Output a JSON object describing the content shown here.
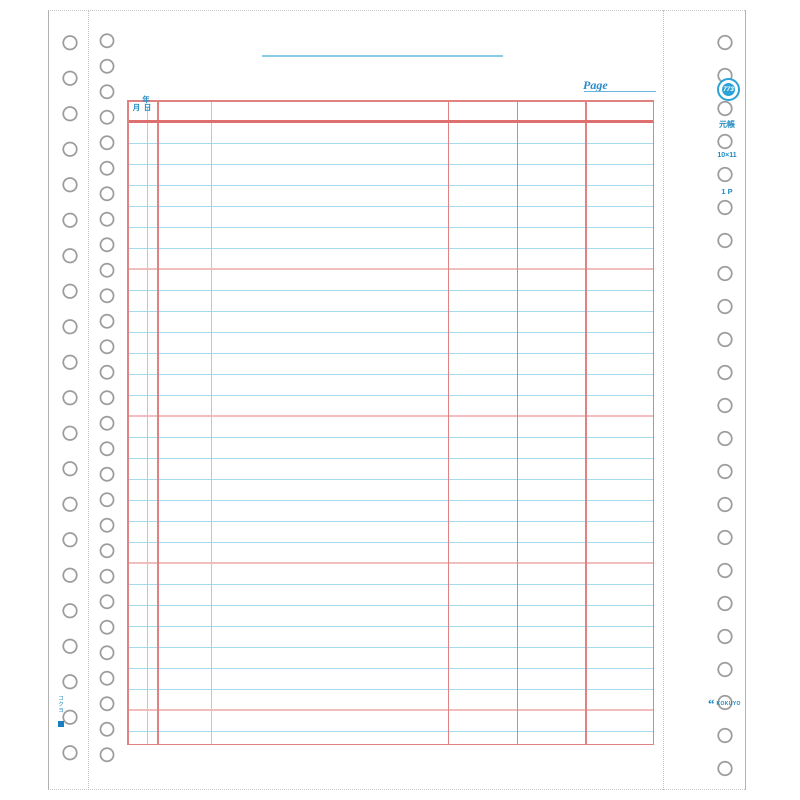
{
  "page": {
    "page_label": "Page",
    "badge_number": "773",
    "side_labels": {
      "form_type": "元帳",
      "size": "10×11",
      "parts": "1 P"
    },
    "table_header": {
      "year": "年",
      "month": "月",
      "day": "日"
    },
    "branding": {
      "logo_mark": "“",
      "maker_name": "KOKUYO",
      "spine_mark": "コクヨ"
    },
    "ruling": {
      "ruled_line_rows": 29,
      "accent_rows_every": 7
    },
    "colors": {
      "ruling_blue": "#a6d9ec",
      "ruling_red": "#e08282",
      "accent_pink": "#f2bdbd",
      "print_blue": "#1f8ac0",
      "badge_blue": "#2ba3d6"
    }
  }
}
